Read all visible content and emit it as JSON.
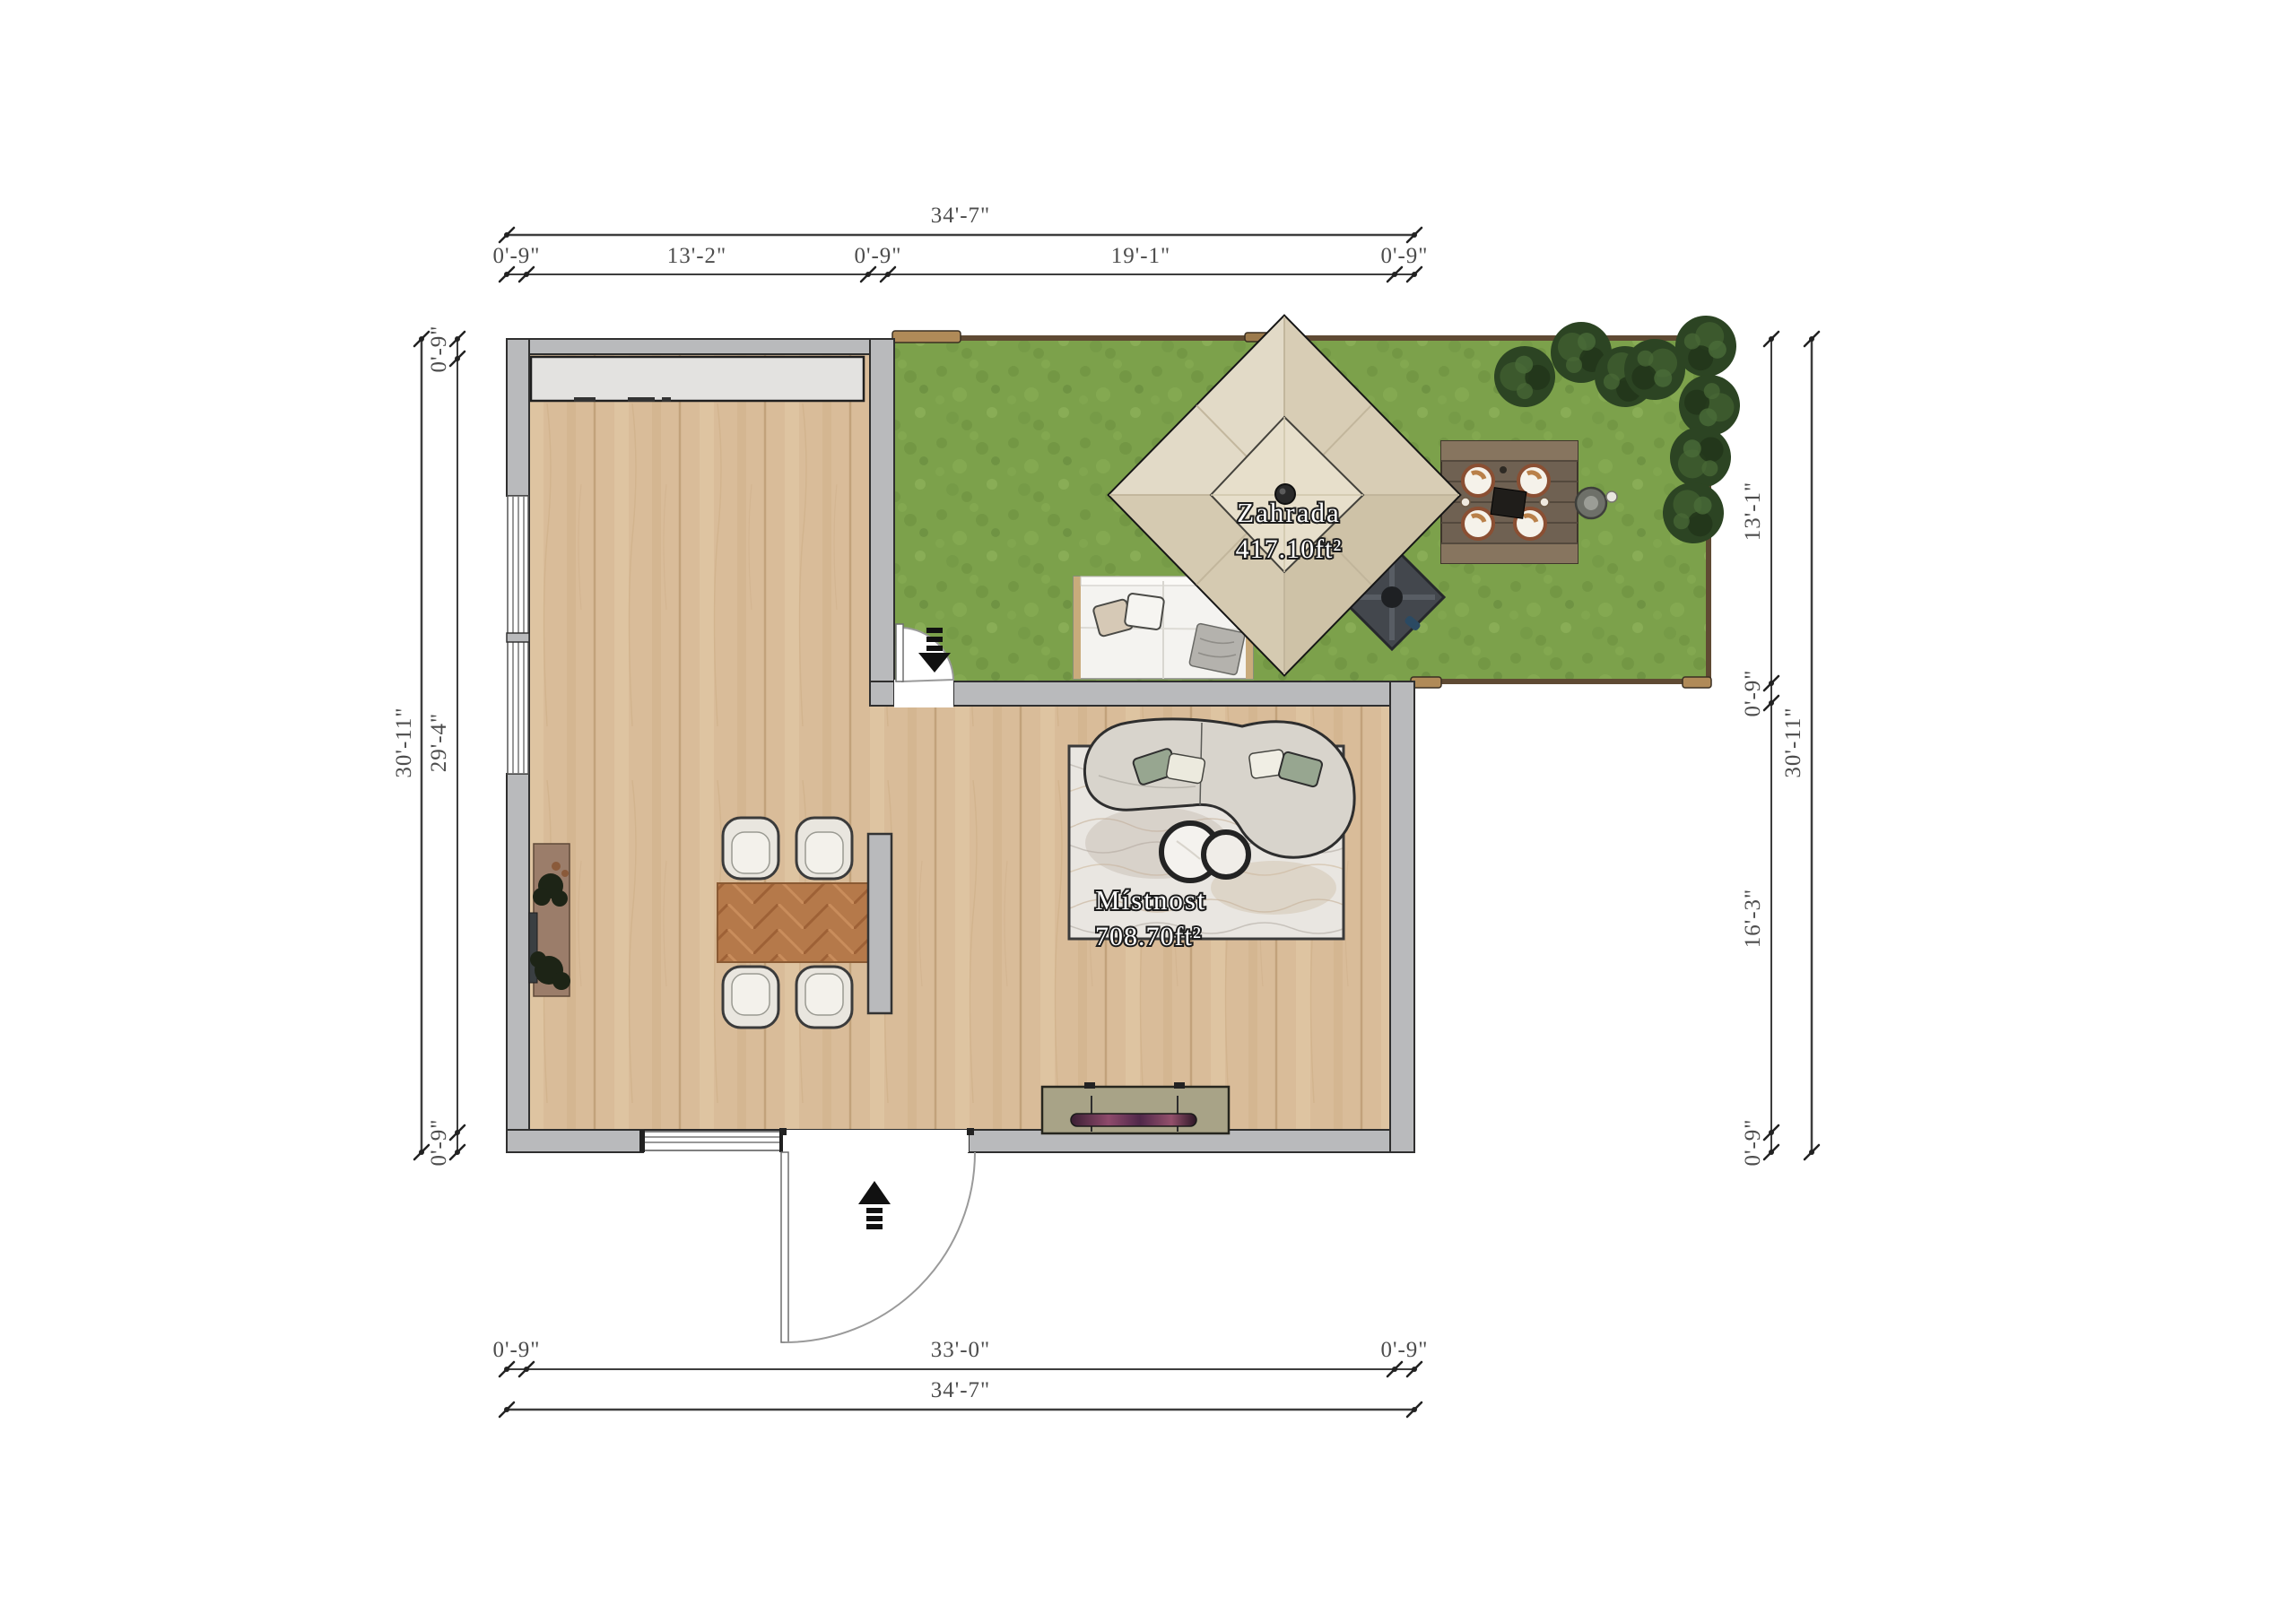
{
  "plan": {
    "type": "floor-plan-top-view",
    "rooms": {
      "garden": {
        "name": "Zahrada",
        "area": "417.10ft²"
      },
      "living": {
        "name": "Místnost",
        "area": "708.70ft²"
      }
    },
    "dimensions": {
      "top": {
        "overall": "34'-7\"",
        "segments": [
          "0'-9\"",
          "13'-2\"",
          "0'-9\"",
          "19'-1\"",
          "0'-9\""
        ]
      },
      "bottom": {
        "overall": "34'-7\"",
        "segments": [
          "0'-9\"",
          "33'-0\"",
          "0'-9\""
        ]
      },
      "left": {
        "overall": "30'-11\"",
        "segments": [
          "0'-9\"",
          "29'-4\"",
          "0'-9\""
        ]
      },
      "right": {
        "overall": "30'-11\"",
        "segments": [
          "13'-1\"",
          "0'-9\"",
          "16'-3\"",
          "0'-9\""
        ]
      }
    },
    "colors": {
      "wall_gray": "#b9babc",
      "floor_wood": "#d9bc99",
      "grass_green": "#7ca14b",
      "tent_canvas": "#dcd2bc",
      "fence_brown": "#6b5537",
      "table_wood": "#b5794a",
      "rug": "#e9e6e1",
      "dim_line": "#3d3d3d"
    }
  }
}
